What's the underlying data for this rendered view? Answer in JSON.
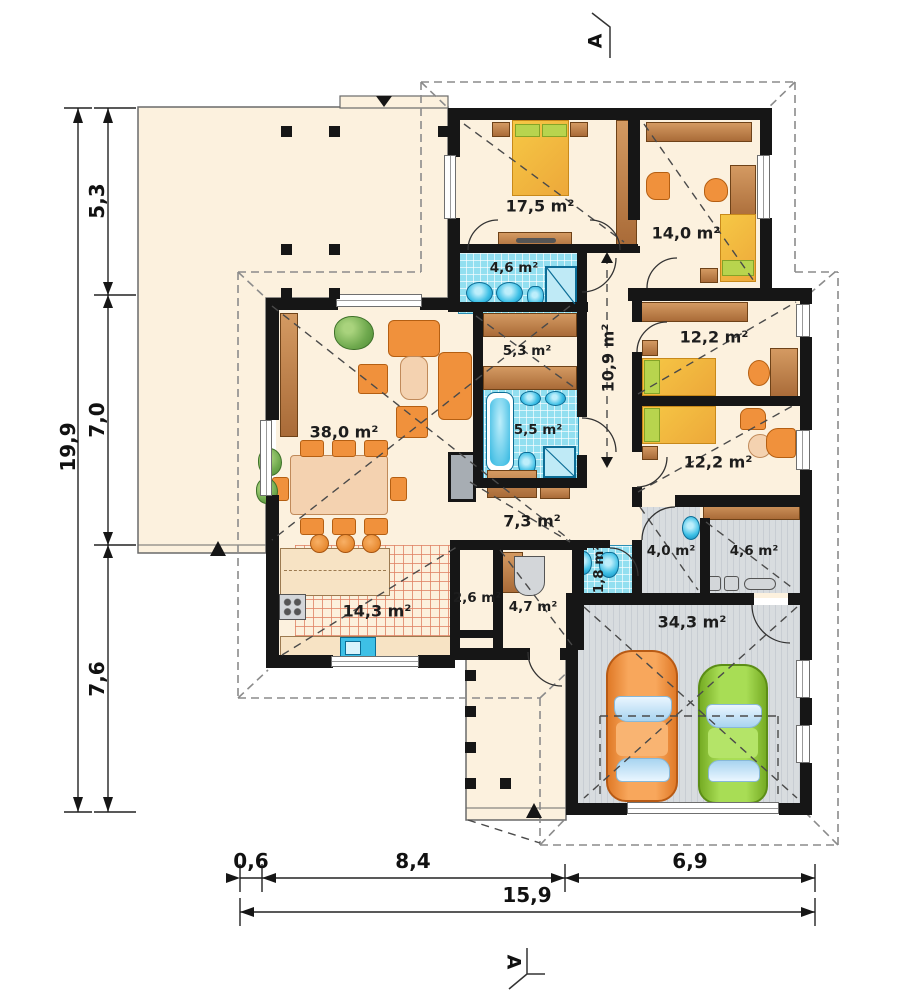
{
  "plan": {
    "rooms": [
      {
        "name": "bedroom-1",
        "label": "17,5 m²"
      },
      {
        "name": "study",
        "label": "14,0 m²"
      },
      {
        "name": "bathroom-1",
        "label": "4,6 m²"
      },
      {
        "name": "wardrobe-hall",
        "label": "5,3 m²"
      },
      {
        "name": "corridor",
        "label": "10,9 m²"
      },
      {
        "name": "bedroom-2",
        "label": "12,2 m²"
      },
      {
        "name": "living-room",
        "label": "38,0 m²"
      },
      {
        "name": "bathroom-2",
        "label": "5,5 m²"
      },
      {
        "name": "bedroom-3",
        "label": "12,2 m²"
      },
      {
        "name": "hall",
        "label": "7,3 m²"
      },
      {
        "name": "wc",
        "label": "1,8 m²"
      },
      {
        "name": "utility-room",
        "label": "4,0 m²"
      },
      {
        "name": "boiler-room",
        "label": "4,6 m²"
      },
      {
        "name": "kitchen",
        "label": "14,3 m²"
      },
      {
        "name": "pantry",
        "label": "2,6 m²"
      },
      {
        "name": "entry-hall",
        "label": "4,7 m²"
      },
      {
        "name": "garage",
        "label": "34,3 m²"
      }
    ],
    "dimensions": {
      "left": {
        "total": "19,9",
        "segments": [
          "5,3",
          "7,0",
          "7,6"
        ]
      },
      "bottom": {
        "total": "15,9",
        "segments": [
          "0,6",
          "8,4",
          "6,9"
        ]
      }
    },
    "section": {
      "top": "A",
      "bottom": "A"
    },
    "colors": {
      "wall": "#161616",
      "floor": "#fcf1de",
      "tile_blue": "#92dff0",
      "wood": "#b5784a",
      "furniture_orange": "#f0913c",
      "bed_yellow": "#f3c044",
      "accent_green": "#b8d44e",
      "garage_gray": "#d0d5da",
      "car_orange": "#f49040",
      "car_green": "#95ce3e"
    }
  }
}
